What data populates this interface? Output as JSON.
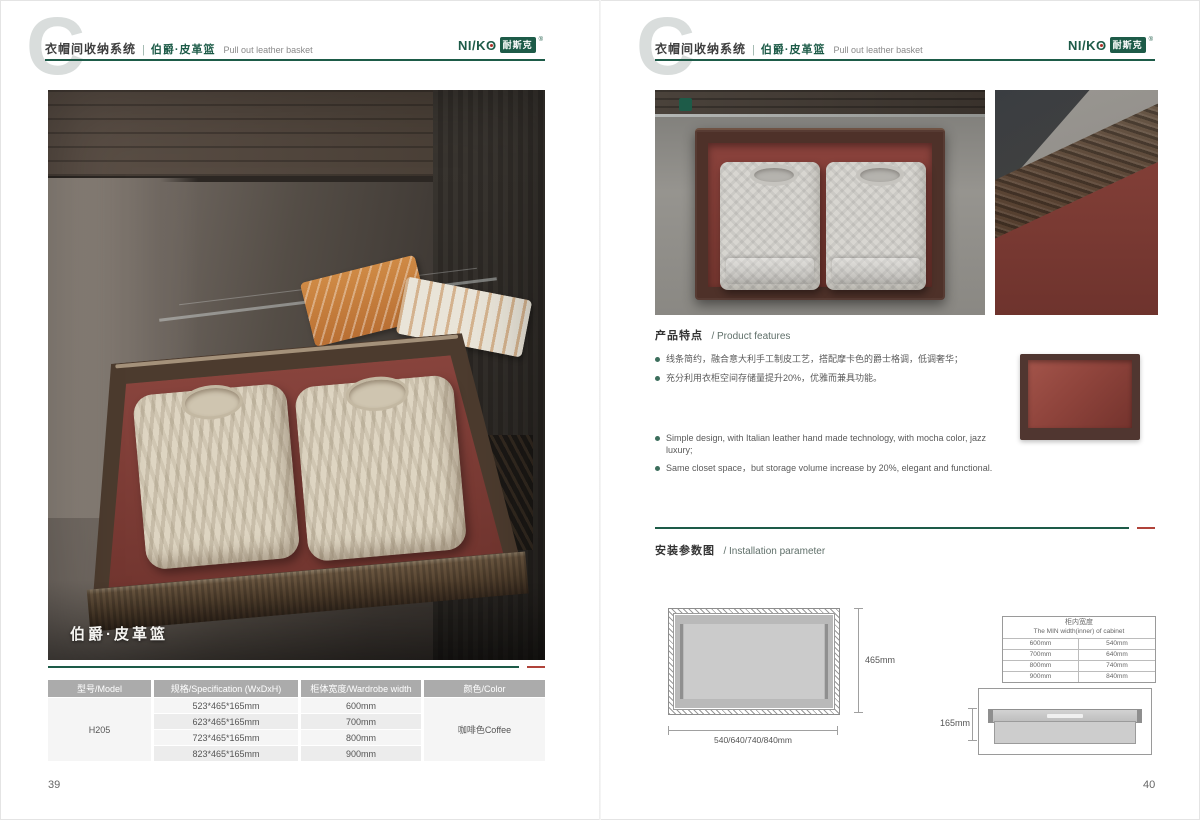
{
  "watermark_letter": "C",
  "brand": {
    "logo_latin": "NI/KO",
    "logo_cn": "耐斯克",
    "registered_mark": "®",
    "green": "#1d5b48",
    "red_accent": "#b0433a"
  },
  "header": {
    "series_cn": "衣帽间收纳系统",
    "separator": "|",
    "product_cn": "伯爵·皮革篮",
    "product_en": "Pull out leather basket"
  },
  "left_page": {
    "photo_caption": "伯爵·皮革篮",
    "page_number": "39",
    "spec_table": {
      "headers": [
        "型号/Model",
        "规格/Specification (WxDxH)",
        "柜体宽度/Wardrobe width",
        "颜色/Color"
      ],
      "model": "H205",
      "rows": [
        {
          "spec": "523*465*165mm",
          "wardrobe_width": "600mm"
        },
        {
          "spec": "623*465*165mm",
          "wardrobe_width": "700mm"
        },
        {
          "spec": "723*465*165mm",
          "wardrobe_width": "800mm"
        },
        {
          "spec": "823*465*165mm",
          "wardrobe_width": "900mm"
        }
      ],
      "color": "咖啡色Coffee"
    }
  },
  "right_page": {
    "page_number": "40",
    "features": {
      "heading_cn": "产品特点",
      "heading_en": "/ Product features",
      "bullets_cn": [
        "线条简约，融合意大利手工制皮工艺，搭配摩卡色的爵士格调，低调奢华；",
        "充分利用衣柜空间存储量提升20%，优雅而兼具功能。"
      ],
      "bullets_en": [
        "Simple design, with Italian leather hand made technology, with mocha color, jazz luxury;",
        "Same closet space，but storage volume increase by 20%, elegant and functional."
      ]
    },
    "installation": {
      "heading_cn": "安装参数图",
      "heading_en": "/ Installation parameter",
      "top_view": {
        "depth": "465mm",
        "widths": "540/640/740/840mm"
      },
      "min_width_table": {
        "title_cn": "柜内宽度",
        "title_en": "The MIN width(inner) of cabinet",
        "rows": [
          [
            "600mm",
            "540mm"
          ],
          [
            "700mm",
            "640mm"
          ],
          [
            "800mm",
            "740mm"
          ],
          [
            "900mm",
            "840mm"
          ]
        ]
      },
      "front_view": {
        "height": "165mm"
      }
    }
  }
}
